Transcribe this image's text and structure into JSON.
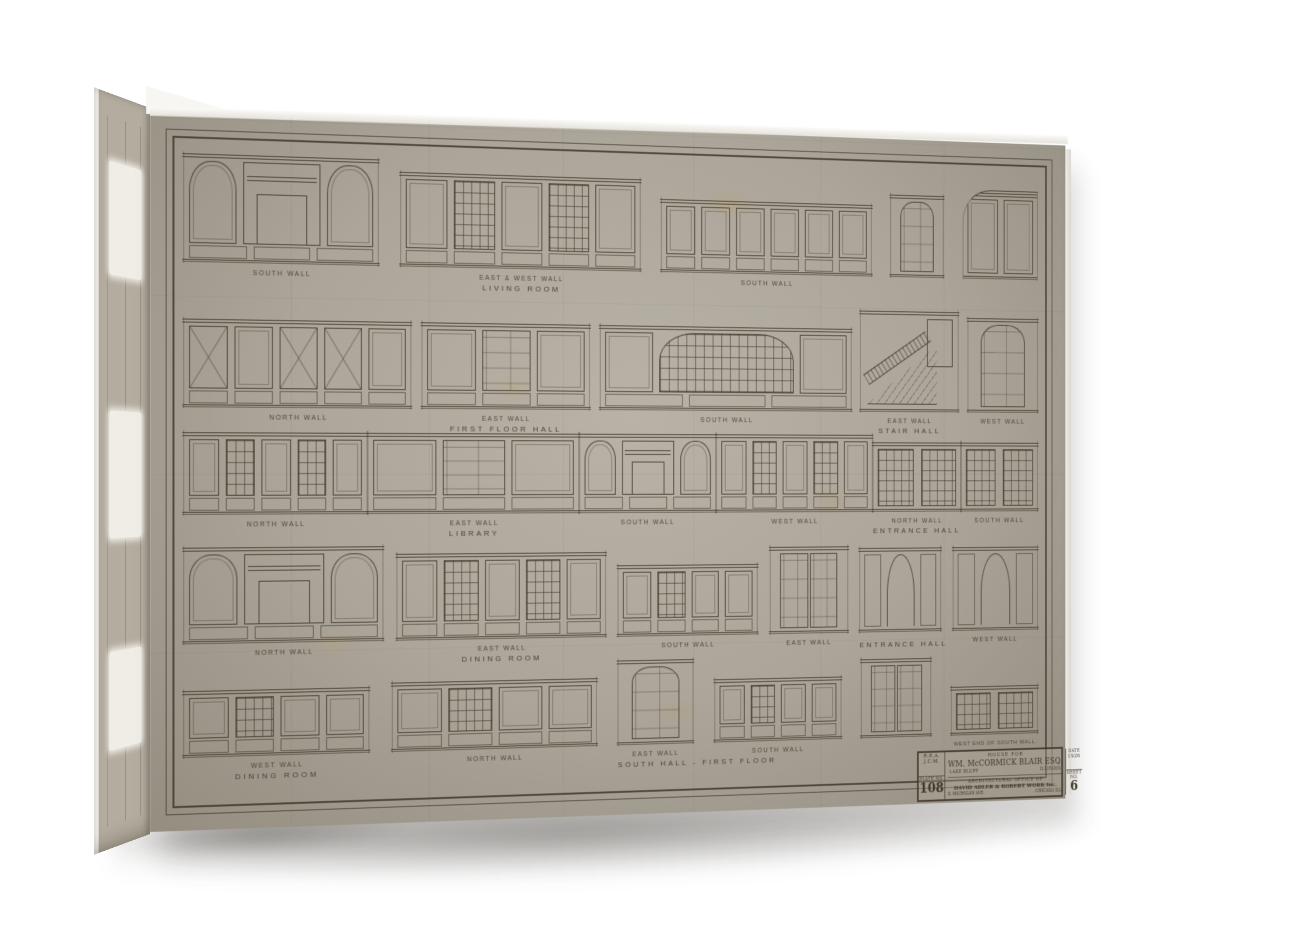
{
  "photo": {
    "background_color": "#ffffff",
    "shadow_color": "rgba(55,50,42,0.40)"
  },
  "canvas": {
    "paper_color": "#aba59a",
    "paper_light": "#b8b2a7",
    "paper_dark": "#948d80",
    "ink_color": "#443b2c",
    "edge_color": "#f3f1ec"
  },
  "sheet": {
    "rows": [
      {
        "top": 2,
        "rh": 140,
        "elevations": [
          {
            "label": "SOUTH WALL",
            "room": "",
            "kind": "mantel",
            "w": 205,
            "h": 112
          },
          {
            "label": "EAST & WEST WALL",
            "room": "LIVING ROOM",
            "kind": "windows",
            "w": 265,
            "h": 100
          },
          {
            "label": "SOUTH WALL",
            "room": "",
            "kind": "panels",
            "w": 245,
            "h": 80
          },
          {
            "label": "",
            "room": "",
            "kind": "door",
            "w": 64,
            "h": 92
          },
          {
            "label": "",
            "room": "",
            "kind": "archcorner",
            "w": 92,
            "h": 98
          }
        ]
      },
      {
        "top": 148,
        "rh": 140,
        "elevations": [
          {
            "label": "NORTH WALL",
            "room": "",
            "kind": "brace",
            "w": 240,
            "h": 92
          },
          {
            "label": "EAST WALL",
            "room": "FIRST FLOOR HALL",
            "kind": "doorpanels",
            "w": 185,
            "h": 92
          },
          {
            "label": "SOUTH WALL",
            "room": "",
            "kind": "bigarch",
            "w": 290,
            "h": 92
          },
          {
            "label": "EAST WALL",
            "room": "STAIR HALL",
            "kind": "stair",
            "w": 118,
            "h": 112
          },
          {
            "label": "WEST WALL",
            "room": "",
            "kind": "door",
            "w": 86,
            "h": 106
          }
        ]
      },
      {
        "top": 282,
        "rh": 114,
        "elevations": [
          {
            "label": "NORTH WALL",
            "room": "",
            "kind": "windows",
            "w": 205,
            "h": 86
          },
          {
            "label": "EAST WALL",
            "room": "LIBRARY",
            "kind": "doorpanels",
            "w": 245,
            "h": 86
          },
          {
            "label": "SOUTH WALL",
            "room": "",
            "kind": "mantel",
            "w": 165,
            "h": 86
          },
          {
            "label": "WEST WALL",
            "room": "",
            "kind": "windows",
            "w": 195,
            "h": 86
          },
          {
            "label": "NORTH WALL",
            "room": "ENTRANCE HALL",
            "kind": "grid",
            "w": 112,
            "h": 78
          },
          {
            "label": "SOUTH WALL",
            "room": "",
            "kind": "grid",
            "w": 100,
            "h": 78
          }
        ]
      },
      {
        "top": 398,
        "rh": 128,
        "elevations": [
          {
            "label": "NORTH WALL",
            "room": "",
            "kind": "mantel",
            "w": 210,
            "h": 100
          },
          {
            "label": "EAST WALL",
            "room": "DINING ROOM",
            "kind": "windows",
            "w": 230,
            "h": 92
          },
          {
            "label": "SOUTH WALL",
            "room": "",
            "kind": "lowwall",
            "w": 160,
            "h": 78
          },
          {
            "label": "EAST WALL",
            "room": "",
            "kind": "doubledoor",
            "w": 92,
            "h": 96
          },
          {
            "label": "",
            "room": "ENTRANCE HALL",
            "kind": "archway",
            "w": 98,
            "h": 94
          },
          {
            "label": "WEST WALL",
            "room": "",
            "kind": "archway",
            "w": 104,
            "h": 94
          }
        ]
      },
      {
        "top": 520,
        "rh": 120,
        "elevations": [
          {
            "label": "WEST WALL",
            "room": "DINING ROOM",
            "kind": "lowwall",
            "w": 195,
            "h": 70
          },
          {
            "label": "NORTH WALL",
            "room": "",
            "kind": "lowwall",
            "w": 225,
            "h": 74
          },
          {
            "label": "EAST WALL",
            "room": "SOUTH HALL - FIRST FLOOR",
            "kind": "door",
            "w": 86,
            "h": 92
          },
          {
            "label": "SOUTH WALL",
            "room": "",
            "kind": "lowwall",
            "w": 148,
            "h": 70
          },
          {
            "label": "",
            "room": "",
            "kind": "doubledoor",
            "w": 84,
            "h": 88
          },
          {
            "label": "WEST END OF SOUTH WALL",
            "room": "",
            "kind": "grid",
            "w": 106,
            "h": 56,
            "small": true
          }
        ]
      }
    ]
  },
  "title_block": {
    "pre_title": "HOUSE FOR",
    "client": "WM. McCORMICK BLAIR ESQ.",
    "place_left": "LAKE BLUFF",
    "place_right": "ILLINOIS",
    "office_line1": "ARCHITECTURAL OFFICE OF",
    "office_line2": "DAVID ADLER & ROBERT WORK Inc.",
    "office_line3": "S. MICHIGAN AVE.",
    "office_line4": "CHICAGO ILL.",
    "drawn_by_1": "R.E.A.",
    "drawn_by_2": "J.C.M.",
    "plate_label": "PLATE NO.",
    "plate_number": "108",
    "date_label": "DATE",
    "date_value": "1926",
    "sheet_label": "SHEET NO.",
    "sheet_number": "6"
  }
}
